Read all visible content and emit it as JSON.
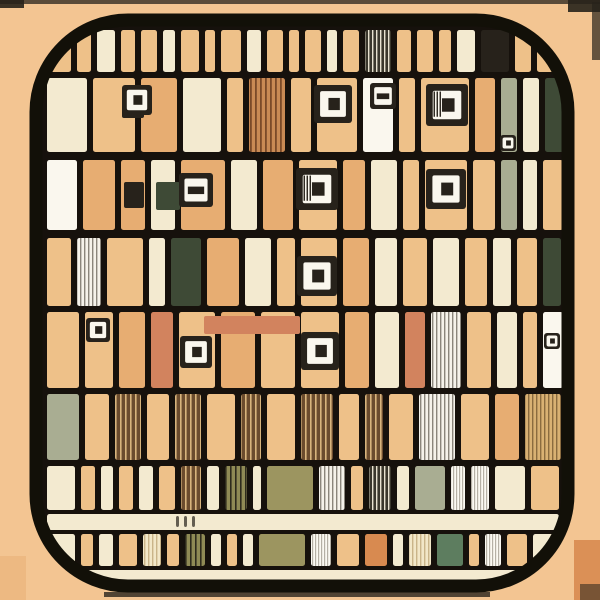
{
  "meta": {
    "description": "Abstract illustrated QR-code grid app icon",
    "canvas": {
      "w": 600,
      "h": 600
    }
  },
  "palette": {
    "bg": "#f3c592",
    "tan": "#eec189",
    "tan2": "#e7ad72",
    "cream": "#f3ead0",
    "white": "#faf7ee",
    "orange": "#d88a50",
    "salmon": "#d2835e",
    "olive": "#9c9560",
    "sage": "#a9ad92",
    "green": "#5d7d5f",
    "darkgreen": "#3e4a36",
    "dark": "#27221b",
    "brown": "#6b4c2e",
    "line": "#16110c",
    "frame": "#121008",
    "highlight": "#8d8d89"
  },
  "frame": {
    "x": 36,
    "y": 20,
    "w": 532,
    "h": 566,
    "rx": 92,
    "stroke_w": 13,
    "inner": {
      "x": 42,
      "y": 26,
      "w": 520,
      "h": 554,
      "rx": 84
    }
  },
  "patterns": [
    {
      "id": "hatch_brown",
      "bg": "#6b4c2e",
      "line": "#d8b47c",
      "gap": 5,
      "line_w": 1.6
    },
    {
      "id": "hatch_gray",
      "bg": "#f5f2ea",
      "line": "#8a857b",
      "gap": 4,
      "line_w": 1.4
    },
    {
      "id": "hatch_white",
      "bg": "#fbf9f2",
      "line": "#b5b0a5",
      "gap": 3,
      "line_w": 1.2
    },
    {
      "id": "hatch_olive",
      "bg": "#8f8a55",
      "line": "#2e2b1d",
      "gap": 5,
      "line_w": 1.6
    },
    {
      "id": "hatch_dark",
      "bg": "#3a372c",
      "line": "#e8e2d0",
      "gap": 4,
      "line_w": 1.4
    },
    {
      "id": "hatch_tan",
      "bg": "#d9b173",
      "line": "#8a6b3f",
      "gap": 4,
      "line_w": 1.4
    },
    {
      "id": "hatch_cream",
      "bg": "#f2e7c8",
      "line": "#c9b489",
      "gap": 4,
      "line_w": 1.4
    },
    {
      "id": "hatch_orange",
      "bg": "#c98a54",
      "line": "#7a4a28",
      "gap": 5,
      "line_w": 1.8
    }
  ],
  "outer_marks": [
    {
      "x": 0,
      "y": 0,
      "w": 600,
      "h": 4,
      "fill": "dark",
      "op": 0.75
    },
    {
      "x": 0,
      "y": 0,
      "w": 24,
      "h": 8,
      "fill": "dark",
      "op": 0.9
    },
    {
      "x": 568,
      "y": 0,
      "w": 32,
      "h": 12,
      "fill": "dark",
      "op": 0.9
    },
    {
      "x": 592,
      "y": 2,
      "w": 8,
      "h": 58,
      "fill": "dark",
      "op": 0.7
    },
    {
      "x": 0,
      "y": 556,
      "w": 26,
      "h": 44,
      "fill": "tan2",
      "op": 0.5
    },
    {
      "x": 104,
      "y": 592,
      "w": 386,
      "h": 5,
      "fill": "dark",
      "op": 0.8
    },
    {
      "x": 574,
      "y": 540,
      "w": 26,
      "h": 60,
      "fill": "orange",
      "op": 0.9
    },
    {
      "x": 580,
      "y": 584,
      "w": 20,
      "h": 16,
      "fill": "dark",
      "op": 0.55
    }
  ],
  "bands": [
    {
      "y": 30,
      "h": 42,
      "cells": [
        [
          46,
          26,
          "tan"
        ],
        [
          76,
          16,
          "tan"
        ],
        [
          96,
          20,
          "cream"
        ],
        [
          120,
          16,
          "tan"
        ],
        [
          140,
          18,
          "tan"
        ],
        [
          162,
          14,
          "cream"
        ],
        [
          180,
          20,
          "tan"
        ],
        [
          204,
          12,
          "tan"
        ],
        [
          220,
          22,
          "tan"
        ],
        [
          246,
          16,
          "cream"
        ],
        [
          266,
          18,
          "tan"
        ],
        [
          288,
          12,
          "tan"
        ],
        [
          304,
          18,
          "tan"
        ],
        [
          326,
          12,
          "cream"
        ],
        [
          342,
          18,
          "tan"
        ],
        [
          364,
          28,
          "hatch_dark"
        ],
        [
          396,
          16,
          "tan"
        ],
        [
          416,
          18,
          "tan"
        ],
        [
          438,
          14,
          "tan"
        ],
        [
          456,
          20,
          "cream"
        ],
        [
          480,
          30,
          "dark"
        ],
        [
          514,
          18,
          "tan"
        ],
        [
          536,
          24,
          "tan"
        ]
      ]
    },
    {
      "y": 78,
      "h": 74,
      "cells": [
        [
          46,
          42,
          "cream"
        ],
        [
          92,
          44,
          "tan"
        ],
        [
          140,
          38,
          "tan2"
        ],
        [
          182,
          40,
          "cream"
        ],
        [
          226,
          18,
          "tan"
        ],
        [
          248,
          38,
          "hatch_orange"
        ],
        [
          290,
          22,
          "tan"
        ],
        [
          316,
          42,
          "tan"
        ],
        [
          362,
          32,
          "white"
        ],
        [
          398,
          18,
          "tan"
        ],
        [
          420,
          50,
          "tan"
        ],
        [
          474,
          22,
          "tan2"
        ],
        [
          500,
          18,
          "sage"
        ],
        [
          522,
          18,
          "cream"
        ],
        [
          544,
          22,
          "darkgreen"
        ]
      ]
    },
    {
      "y": 160,
      "h": 70,
      "cells": [
        [
          46,
          32,
          "white"
        ],
        [
          82,
          34,
          "tan2"
        ],
        [
          120,
          26,
          "tan2"
        ],
        [
          150,
          26,
          "cream"
        ],
        [
          180,
          46,
          "tan2"
        ],
        [
          230,
          28,
          "cream"
        ],
        [
          262,
          32,
          "tan2"
        ],
        [
          298,
          40,
          "tan"
        ],
        [
          342,
          24,
          "tan2"
        ],
        [
          370,
          28,
          "cream"
        ],
        [
          402,
          18,
          "tan"
        ],
        [
          424,
          44,
          "tan"
        ],
        [
          472,
          24,
          "tan"
        ],
        [
          500,
          18,
          "sage"
        ],
        [
          522,
          16,
          "cream"
        ],
        [
          542,
          22,
          "tan"
        ]
      ]
    },
    {
      "y": 238,
      "h": 68,
      "cells": [
        [
          46,
          26,
          "tan"
        ],
        [
          76,
          26,
          "hatch_gray"
        ],
        [
          106,
          38,
          "tan"
        ],
        [
          148,
          18,
          "cream"
        ],
        [
          170,
          32,
          "darkgreen"
        ],
        [
          206,
          34,
          "tan2"
        ],
        [
          244,
          28,
          "cream"
        ],
        [
          276,
          20,
          "tan"
        ],
        [
          300,
          38,
          "tan"
        ],
        [
          342,
          28,
          "tan2"
        ],
        [
          374,
          24,
          "cream"
        ],
        [
          402,
          26,
          "tan"
        ],
        [
          432,
          28,
          "cream"
        ],
        [
          464,
          24,
          "tan"
        ],
        [
          492,
          20,
          "cream"
        ],
        [
          516,
          22,
          "tan"
        ],
        [
          542,
          20,
          "darkgreen"
        ]
      ]
    },
    {
      "y": 312,
      "h": 76,
      "cells": [
        [
          46,
          34,
          "tan"
        ],
        [
          84,
          30,
          "tan"
        ],
        [
          118,
          28,
          "tan2"
        ],
        [
          150,
          24,
          "salmon"
        ],
        [
          178,
          38,
          "tan"
        ],
        [
          220,
          36,
          "tan2"
        ],
        [
          260,
          36,
          "tan"
        ],
        [
          300,
          40,
          "tan"
        ],
        [
          344,
          26,
          "tan2"
        ],
        [
          374,
          26,
          "cream"
        ],
        [
          404,
          22,
          "salmon"
        ],
        [
          430,
          32,
          "hatch_gray"
        ],
        [
          466,
          26,
          "tan"
        ],
        [
          496,
          22,
          "cream"
        ],
        [
          522,
          16,
          "tan"
        ],
        [
          542,
          22,
          "white"
        ]
      ]
    },
    {
      "y": 394,
      "h": 66,
      "cells": [
        [
          46,
          34,
          "sage"
        ],
        [
          84,
          26,
          "tan"
        ],
        [
          114,
          28,
          "hatch_brown"
        ],
        [
          146,
          24,
          "tan"
        ],
        [
          174,
          28,
          "hatch_brown"
        ],
        [
          206,
          30,
          "tan"
        ],
        [
          240,
          22,
          "hatch_brown"
        ],
        [
          266,
          30,
          "tan"
        ],
        [
          300,
          34,
          "hatch_brown"
        ],
        [
          338,
          22,
          "tan"
        ],
        [
          364,
          20,
          "hatch_brown"
        ],
        [
          388,
          26,
          "tan"
        ],
        [
          418,
          38,
          "hatch_gray"
        ],
        [
          460,
          30,
          "tan"
        ],
        [
          494,
          26,
          "tan2"
        ],
        [
          524,
          38,
          "hatch_tan"
        ]
      ]
    },
    {
      "y": 466,
      "h": 44,
      "cells": [
        [
          46,
          30,
          "cream"
        ],
        [
          80,
          16,
          "tan"
        ],
        [
          100,
          14,
          "cream"
        ],
        [
          118,
          16,
          "tan"
        ],
        [
          138,
          16,
          "cream"
        ],
        [
          158,
          18,
          "tan"
        ],
        [
          180,
          22,
          "hatch_brown"
        ],
        [
          206,
          14,
          "cream"
        ],
        [
          224,
          24,
          "hatch_olive"
        ],
        [
          252,
          10,
          "cream"
        ],
        [
          266,
          48,
          "olive"
        ],
        [
          318,
          28,
          "hatch_gray"
        ],
        [
          350,
          14,
          "tan"
        ],
        [
          368,
          24,
          "hatch_dark"
        ],
        [
          396,
          14,
          "cream"
        ],
        [
          414,
          32,
          "sage"
        ],
        [
          450,
          16,
          "hatch_white"
        ],
        [
          470,
          20,
          "hatch_white"
        ],
        [
          494,
          32,
          "cream"
        ],
        [
          530,
          30,
          "tan"
        ]
      ]
    },
    {
      "y": 514,
      "h": 16,
      "cells": [
        [
          46,
          514,
          "cream"
        ]
      ]
    },
    {
      "y": 534,
      "h": 32,
      "cells": [
        [
          46,
          30,
          "cream"
        ],
        [
          80,
          14,
          "tan"
        ],
        [
          98,
          16,
          "cream"
        ],
        [
          118,
          20,
          "tan"
        ],
        [
          142,
          20,
          "hatch_cream"
        ],
        [
          166,
          14,
          "tan"
        ],
        [
          184,
          22,
          "hatch_olive"
        ],
        [
          210,
          12,
          "cream"
        ],
        [
          226,
          12,
          "tan"
        ],
        [
          242,
          12,
          "cream"
        ],
        [
          258,
          48,
          "olive"
        ],
        [
          310,
          22,
          "hatch_white"
        ],
        [
          336,
          24,
          "tan"
        ],
        [
          364,
          24,
          "orange"
        ],
        [
          392,
          12,
          "cream"
        ],
        [
          408,
          24,
          "hatch_cream"
        ],
        [
          436,
          28,
          "green"
        ],
        [
          468,
          12,
          "tan"
        ],
        [
          484,
          18,
          "hatch_white"
        ],
        [
          506,
          22,
          "tan"
        ],
        [
          532,
          28,
          "cream"
        ]
      ]
    },
    {
      "y": 570,
      "h": 12,
      "cells": [
        [
          46,
          514,
          "cream"
        ]
      ]
    }
  ],
  "features": [
    {
      "x": 122,
      "y": 88,
      "w": 22,
      "h": 30,
      "fill": "dark"
    },
    {
      "x": 124,
      "y": 182,
      "w": 20,
      "h": 26,
      "fill": "dark"
    },
    {
      "x": 156,
      "y": 182,
      "w": 24,
      "h": 28,
      "fill": "darkgreen"
    },
    {
      "x": 204,
      "y": 316,
      "w": 96,
      "h": 18,
      "fill": "salmon"
    },
    {
      "x": 176,
      "y": 516,
      "w": 3,
      "h": 11,
      "fill": "dark",
      "op": 0.7
    },
    {
      "x": 184,
      "y": 516,
      "w": 3,
      "h": 11,
      "fill": "dark",
      "op": 0.7
    },
    {
      "x": 192,
      "y": 516,
      "w": 3,
      "h": 11,
      "fill": "dark",
      "op": 0.7
    }
  ],
  "eyes": [
    {
      "cx": 137,
      "cy": 100,
      "s": 30,
      "dot": "square"
    },
    {
      "cx": 333,
      "cy": 104,
      "s": 38,
      "dot": "square"
    },
    {
      "cx": 447,
      "cy": 105,
      "s": 42,
      "dot": "square",
      "stripe": true
    },
    {
      "cx": 383,
      "cy": 96,
      "s": 26,
      "dot": "bar"
    },
    {
      "cx": 317,
      "cy": 189,
      "s": 42,
      "dot": "square",
      "stripe": true
    },
    {
      "cx": 446,
      "cy": 189,
      "s": 40,
      "dot": "square"
    },
    {
      "cx": 196,
      "cy": 190,
      "s": 34,
      "dot": "bar"
    },
    {
      "cx": 317,
      "cy": 276,
      "s": 40,
      "dot": "square"
    },
    {
      "cx": 320,
      "cy": 351,
      "s": 38,
      "dot": "square"
    },
    {
      "cx": 196,
      "cy": 352,
      "s": 32,
      "dot": "square"
    },
    {
      "cx": 98,
      "cy": 330,
      "s": 24,
      "dot": "square"
    },
    {
      "cx": 552,
      "cy": 341,
      "s": 16,
      "dot": "square"
    },
    {
      "cx": 508,
      "cy": 143,
      "s": 16,
      "dot": "square"
    }
  ]
}
